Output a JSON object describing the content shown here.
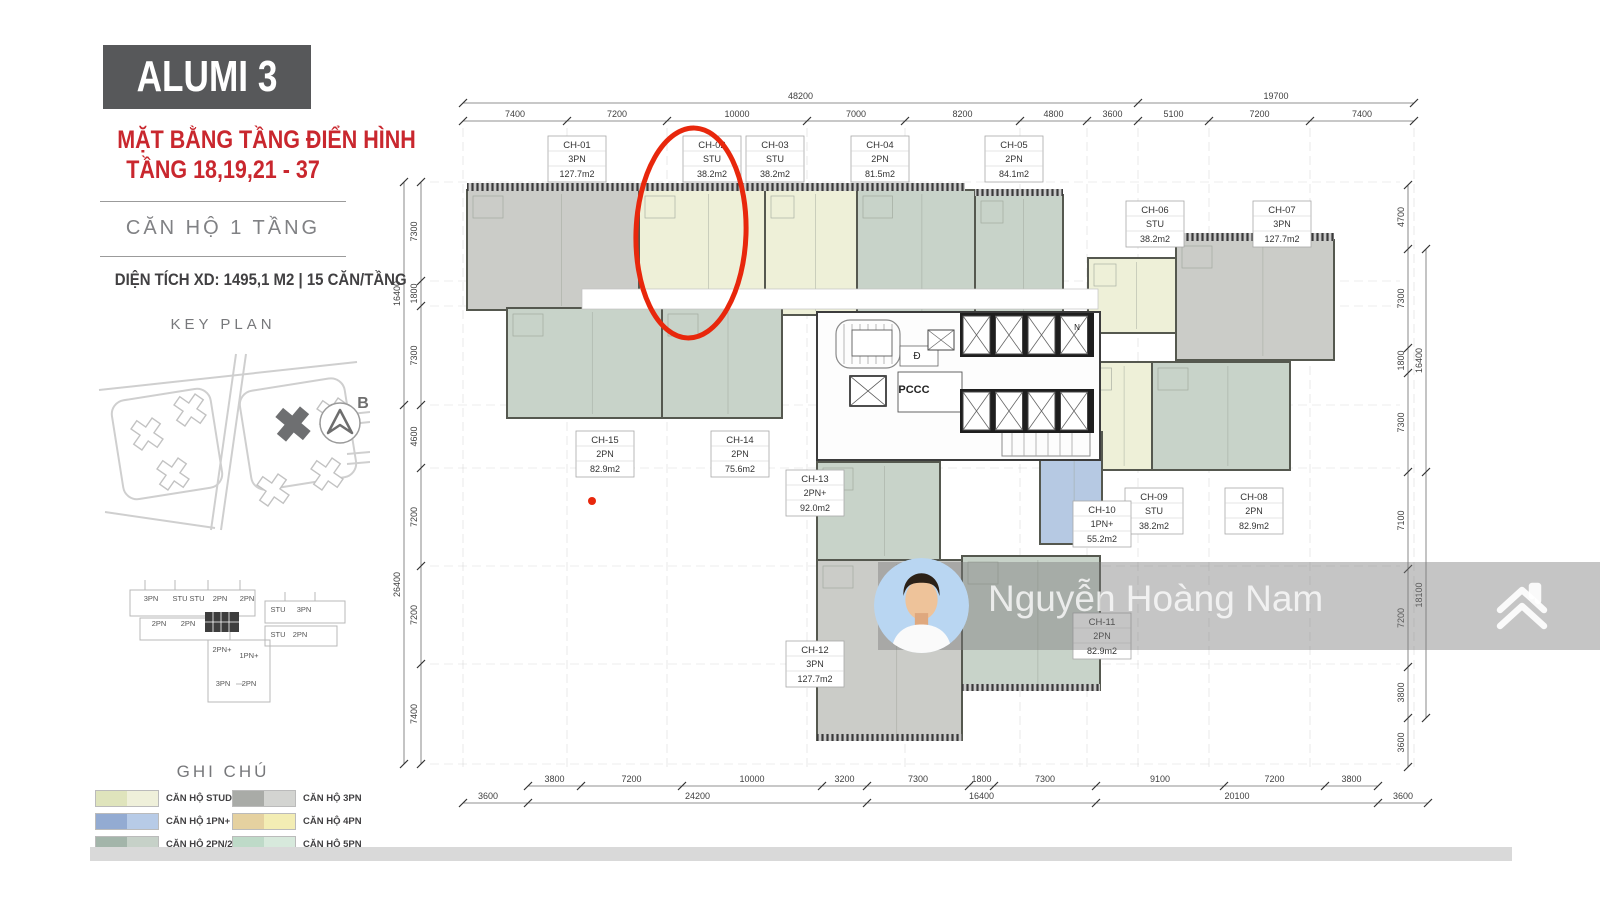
{
  "page": {
    "background": "#ffffff",
    "footer_bar_color": "#d9d9d9"
  },
  "sidebar": {
    "title": "ALUMI 3",
    "heading_line1": "MẶT BẰNG TẦNG ĐIỂN HÌNH",
    "heading_line2": "TẦNG 18,19,21 - 37",
    "unit_floor_note": "CĂN HỘ 1 TẦNG",
    "area_note": "DIỆN TÍCH XD: 1495,1 M2  |  15 CĂN/TẦNG",
    "key_plan_title": "KEY PLAN",
    "compass_label": "B",
    "legend_title": "GHI CHÚ",
    "legend_items": [
      {
        "label": "CĂN HỘ STUDIO",
        "c1": "#dfe4bc",
        "c2": "#eff0da"
      },
      {
        "label": "CĂN HỘ 1PN+",
        "c1": "#93abd2",
        "c2": "#b7cbe7"
      },
      {
        "label": "CĂN HỘ 2PN/2PN+",
        "c1": "#a3b5aa",
        "c2": "#c6d1c8"
      },
      {
        "label": "CĂN HỘ 3PN",
        "c1": "#a9aba7",
        "c2": "#d3d4d1"
      },
      {
        "label": "CĂN HỘ 4PN",
        "c1": "#e5d1a0",
        "c2": "#f3edb4"
      },
      {
        "label": "CĂN HỘ 5PN",
        "c1": "#bedac8",
        "c2": "#d7e9dc"
      }
    ],
    "mini_plan_labels": [
      {
        "t": "3PN",
        "x": 51,
        "y": 31
      },
      {
        "t": "STU",
        "x": 80,
        "y": 31
      },
      {
        "t": "STU",
        "x": 97,
        "y": 31
      },
      {
        "t": "2PN",
        "x": 120,
        "y": 31
      },
      {
        "t": "2PN",
        "x": 147,
        "y": 31
      },
      {
        "t": "STU",
        "x": 178,
        "y": 42
      },
      {
        "t": "3PN",
        "x": 204,
        "y": 42
      },
      {
        "t": "2PN",
        "x": 59,
        "y": 56
      },
      {
        "t": "2PN",
        "x": 88,
        "y": 56
      },
      {
        "t": "STU",
        "x": 178,
        "y": 67
      },
      {
        "t": "2PN",
        "x": 200,
        "y": 67
      },
      {
        "t": "2PN+",
        "x": 122,
        "y": 82
      },
      {
        "t": "1PN+",
        "x": 149,
        "y": 88
      },
      {
        "t": "3PN",
        "x": 123,
        "y": 116
      },
      {
        "t": "2PN",
        "x": 149,
        "y": 116
      }
    ]
  },
  "plan": {
    "unit_colors": {
      "stu": "#eef0d8",
      "1pn": "#b6c9e3",
      "2pn": "#c8d3c9",
      "3pn": "#cbccc8"
    },
    "wall_color": "#55584f",
    "units": [
      {
        "id": "CH-01",
        "type": "3PN",
        "area": "127.7m2",
        "cls": "3pn",
        "x": 467,
        "y": 190,
        "w": 172,
        "h": 120,
        "lx": 548,
        "ly": 136
      },
      {
        "id": "CH-02",
        "type": "STU",
        "area": "38.2m2",
        "cls": "stu",
        "x": 639,
        "y": 190,
        "w": 126,
        "h": 120,
        "lx": 683,
        "ly": 136
      },
      {
        "id": "CH-03",
        "type": "STU",
        "area": "38.2m2",
        "cls": "stu",
        "x": 765,
        "y": 190,
        "w": 92,
        "h": 125,
        "lx": 746,
        "ly": 136
      },
      {
        "id": "CH-04",
        "type": "2PN",
        "area": "81.5m2",
        "cls": "2pn",
        "x": 857,
        "y": 190,
        "w": 118,
        "h": 125,
        "lx": 851,
        "ly": 136
      },
      {
        "id": "CH-05",
        "type": "2PN",
        "area": "84.1m2",
        "cls": "2pn",
        "x": 975,
        "y": 195,
        "w": 88,
        "h": 135,
        "lx": 985,
        "ly": 136
      },
      {
        "id": "CH-06",
        "type": "STU",
        "area": "38.2m2",
        "cls": "stu",
        "x": 1088,
        "y": 258,
        "w": 88,
        "h": 75,
        "lx": 1126,
        "ly": 201
      },
      {
        "id": "CH-07",
        "type": "3PN",
        "area": "127.7m2",
        "cls": "3pn",
        "x": 1176,
        "y": 240,
        "w": 158,
        "h": 120,
        "lx": 1253,
        "ly": 201
      },
      {
        "id": "CH-08",
        "type": "2PN",
        "area": "82.9m2",
        "cls": "2pn",
        "x": 1152,
        "y": 362,
        "w": 138,
        "h": 108,
        "lx": 1225,
        "ly": 488
      },
      {
        "id": "CH-09",
        "type": "STU",
        "area": "38.2m2",
        "cls": "stu",
        "x": 1090,
        "y": 362,
        "w": 62,
        "h": 108,
        "lx": 1125,
        "ly": 488
      },
      {
        "id": "CH-10",
        "type": "1PN+",
        "area": "55.2m2",
        "cls": "1pn",
        "x": 1040,
        "y": 432,
        "w": 62,
        "h": 112,
        "lx": 1073,
        "ly": 501
      },
      {
        "id": "CH-11",
        "type": "2PN",
        "area": "82.9m2",
        "cls": "2pn",
        "x": 962,
        "y": 556,
        "w": 138,
        "h": 134,
        "lx": 1073,
        "ly": 613
      },
      {
        "id": "CH-12",
        "type": "3PN",
        "area": "127.7m2",
        "cls": "3pn",
        "x": 817,
        "y": 560,
        "w": 145,
        "h": 180,
        "lx": 786,
        "ly": 641
      },
      {
        "id": "CH-13",
        "type": "2PN+",
        "area": "92.0m2",
        "cls": "2pn",
        "x": 817,
        "y": 462,
        "w": 123,
        "h": 98,
        "lx": 786,
        "ly": 470
      },
      {
        "id": "CH-14",
        "type": "2PN",
        "area": "75.6m2",
        "cls": "2pn",
        "x": 662,
        "y": 308,
        "w": 120,
        "h": 110,
        "lx": 711,
        "ly": 431
      },
      {
        "id": "CH-15",
        "type": "2PN",
        "area": "82.9m2",
        "cls": "2pn",
        "x": 507,
        "y": 308,
        "w": 155,
        "h": 110,
        "lx": 576,
        "ly": 431
      }
    ],
    "core_labels": [
      {
        "t": "Đ",
        "x": 917,
        "y": 359,
        "s": 10
      },
      {
        "t": "PCCC",
        "x": 914,
        "y": 393,
        "s": 11
      },
      {
        "t": "N",
        "x": 1077,
        "y": 330,
        "s": 8
      }
    ],
    "dims": {
      "top_outer": [
        {
          "label": "48200",
          "a": 463,
          "b": 1138
        },
        {
          "label": "19700",
          "a": 1138,
          "b": 1414
        }
      ],
      "top_inner": [
        {
          "label": "7400",
          "a": 463,
          "b": 567
        },
        {
          "label": "7200",
          "a": 567,
          "b": 667
        },
        {
          "label": "10000",
          "a": 667,
          "b": 807
        },
        {
          "label": "7000",
          "a": 807,
          "b": 905
        },
        {
          "label": "8200",
          "a": 905,
          "b": 1020
        },
        {
          "label": "4800",
          "a": 1020,
          "b": 1087
        },
        {
          "label": "3600",
          "a": 1087,
          "b": 1138
        },
        {
          "label": "5100",
          "a": 1138,
          "b": 1209
        },
        {
          "label": "7200",
          "a": 1209,
          "b": 1310
        },
        {
          "label": "7400",
          "a": 1310,
          "b": 1414
        }
      ],
      "bottom_inner": [
        {
          "label": "3800",
          "a": 528,
          "b": 581
        },
        {
          "label": "7200",
          "a": 581,
          "b": 682
        },
        {
          "label": "10000",
          "a": 682,
          "b": 822
        },
        {
          "label": "3200",
          "a": 822,
          "b": 867
        },
        {
          "label": "7300",
          "a": 867,
          "b": 969
        },
        {
          "label": "1800",
          "a": 969,
          "b": 994
        },
        {
          "label": "7300",
          "a": 994,
          "b": 1096
        },
        {
          "label": "9100",
          "a": 1096,
          "b": 1224
        },
        {
          "label": "7200",
          "a": 1224,
          "b": 1325
        },
        {
          "label": "3800",
          "a": 1325,
          "b": 1378
        }
      ],
      "bottom_outer": [
        {
          "label": "3600",
          "a": 463,
          "b": 513
        },
        {
          "label": "24200",
          "a": 528,
          "b": 867
        },
        {
          "label": "16400",
          "a": 867,
          "b": 1096
        },
        {
          "label": "20100",
          "a": 1096,
          "b": 1378
        },
        {
          "label": "3600",
          "a": 1378,
          "b": 1428
        }
      ],
      "left_inner": [
        {
          "label": "7300",
          "a": 182,
          "b": 281
        },
        {
          "label": "1800",
          "a": 281,
          "b": 306
        },
        {
          "label": "7300",
          "a": 306,
          "b": 405
        },
        {
          "label": "4600",
          "a": 405,
          "b": 468
        },
        {
          "label": "7200",
          "a": 468,
          "b": 566
        },
        {
          "label": "7200",
          "a": 566,
          "b": 664
        },
        {
          "label": "7400",
          "a": 664,
          "b": 764
        }
      ],
      "left_outer": [
        {
          "label": "16400",
          "a": 182,
          "b": 405
        },
        {
          "label": "26400",
          "a": 405,
          "b": 764
        }
      ],
      "right_inner": [
        {
          "label": "4700",
          "a": 185,
          "b": 249
        },
        {
          "label": "7300",
          "a": 249,
          "b": 348
        },
        {
          "label": "1800",
          "a": 348,
          "b": 373
        },
        {
          "label": "7300",
          "a": 373,
          "b": 472
        },
        {
          "label": "7100",
          "a": 472,
          "b": 569
        },
        {
          "label": "7200",
          "a": 569,
          "b": 667
        },
        {
          "label": "3800",
          "a": 667,
          "b": 718
        },
        {
          "label": "3600",
          "a": 718,
          "b": 767
        }
      ],
      "right_outer": [
        {
          "label": "16400",
          "a": 249,
          "b": 472
        },
        {
          "label": "18100",
          "a": 472,
          "b": 718
        }
      ]
    }
  },
  "annotation": {
    "color": "#e8270c",
    "ellipse": {
      "cx": 691,
      "cy": 233,
      "rx": 55,
      "ry": 105
    },
    "dot": {
      "cx": 592,
      "cy": 501,
      "r": 4
    }
  },
  "watermark": {
    "name": "Nguyễn Hoàng Nam"
  }
}
